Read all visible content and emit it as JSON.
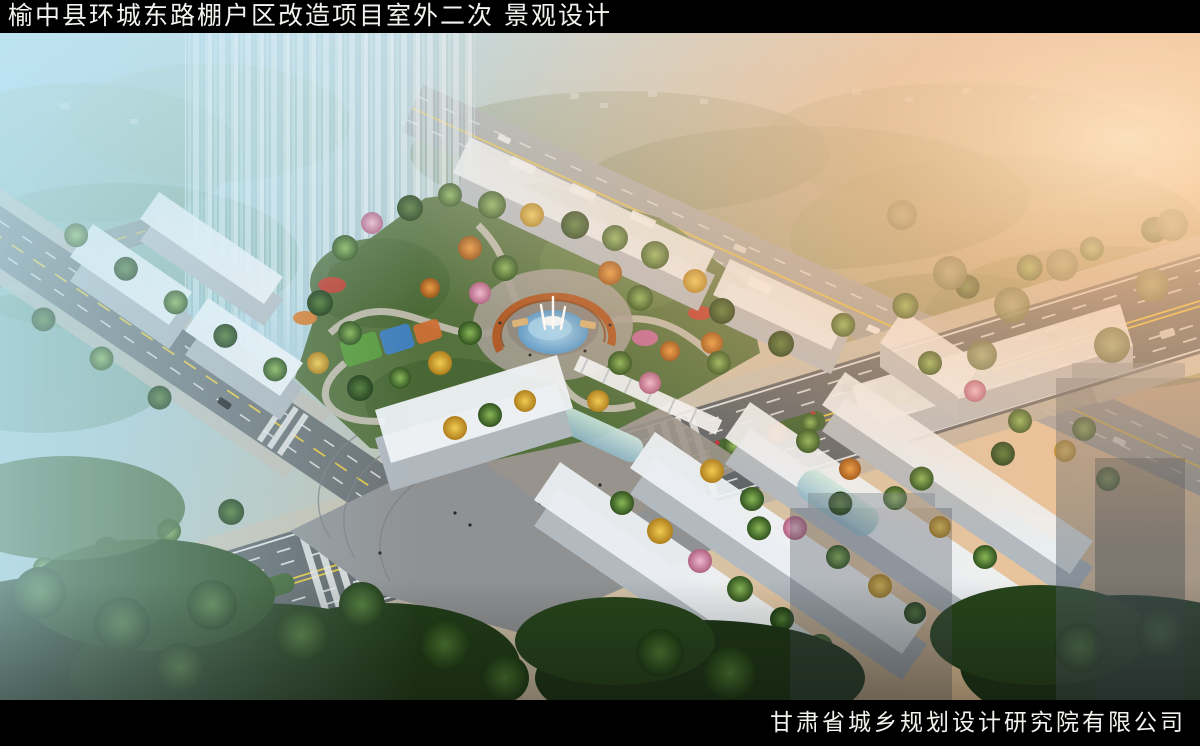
{
  "header": {
    "title": "榆中县环城东路棚户区改造项目室外二次 景观设计"
  },
  "footer": {
    "company": "甘肃省城乡规划设计研究院有限公司"
  },
  "scene": {
    "palette": {
      "sky_left": "#98cfe4",
      "sunglow_right": "#ffc08a",
      "building_white": "#eef2f5",
      "road_asphalt": "#5e6467",
      "paver_plaza": "#8f9193",
      "park_green": "#55713d",
      "autumn_yellow": "#e0b93c",
      "pergola_rust": "#b05a26",
      "fountain_water": "#6ea9d6",
      "bar_black": "#000000",
      "title_white": "#f2f2ee"
    }
  }
}
